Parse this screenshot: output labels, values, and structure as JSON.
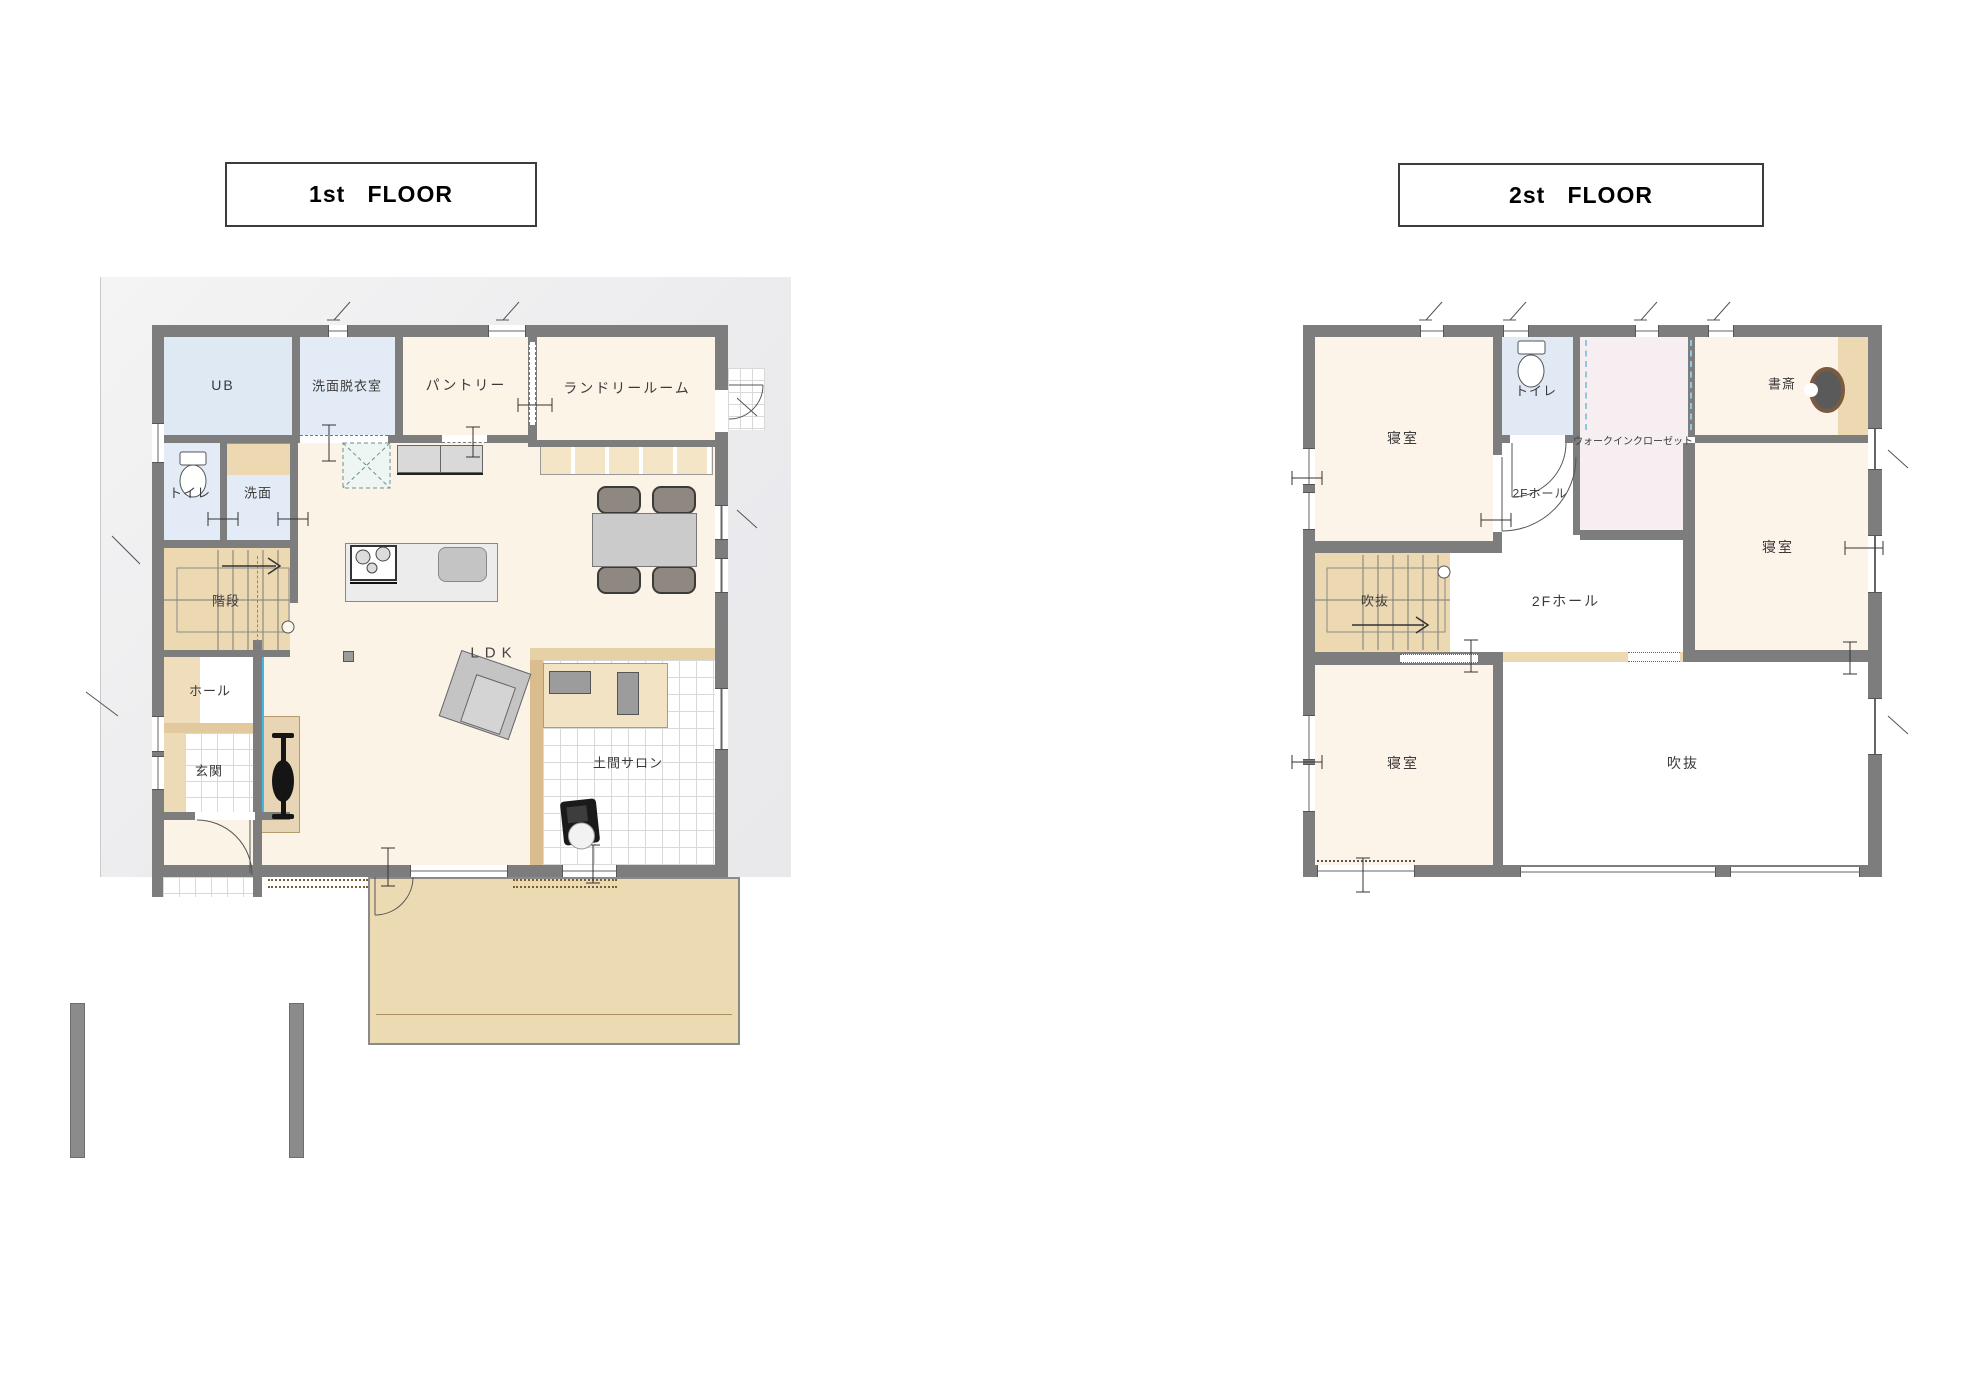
{
  "floor1": {
    "title": "1st   FLOOR",
    "rooms": {
      "ub": "UB",
      "senmen_datsuishitsu": "洗面脱衣室",
      "pantry": "パントリー",
      "laundry": "ランドリールーム",
      "toilet": "トイレ",
      "senmen": "洗面",
      "kaidan": "階段",
      "hall": "ホール",
      "genkan": "玄関",
      "ldk": "LDK",
      "doma_salon": "土間サロン"
    }
  },
  "floor2": {
    "title": "2st   FLOOR",
    "rooms": {
      "bedroom_nw": "寝室",
      "toilet": "トイレ",
      "wic": "ウォークインクローゼット",
      "study": "書斎",
      "hall_small": "2Fホール",
      "stair_void": "吹抜",
      "hall_center": "2Fホール",
      "bedroom_e": "寝室",
      "bedroom_sw": "寝室",
      "void": "吹抜"
    }
  },
  "colors": {
    "wall": "#7d7d7d",
    "room_cream": "#fcf3e6",
    "room_water_blue": "#dfe9f4",
    "tan_wood": "#ecd9b2",
    "wic_pink": "#f7eef1",
    "glass_cyan": "#45b5e6",
    "site_gray": "#ededed",
    "deck_tan": "#ecdab3"
  }
}
